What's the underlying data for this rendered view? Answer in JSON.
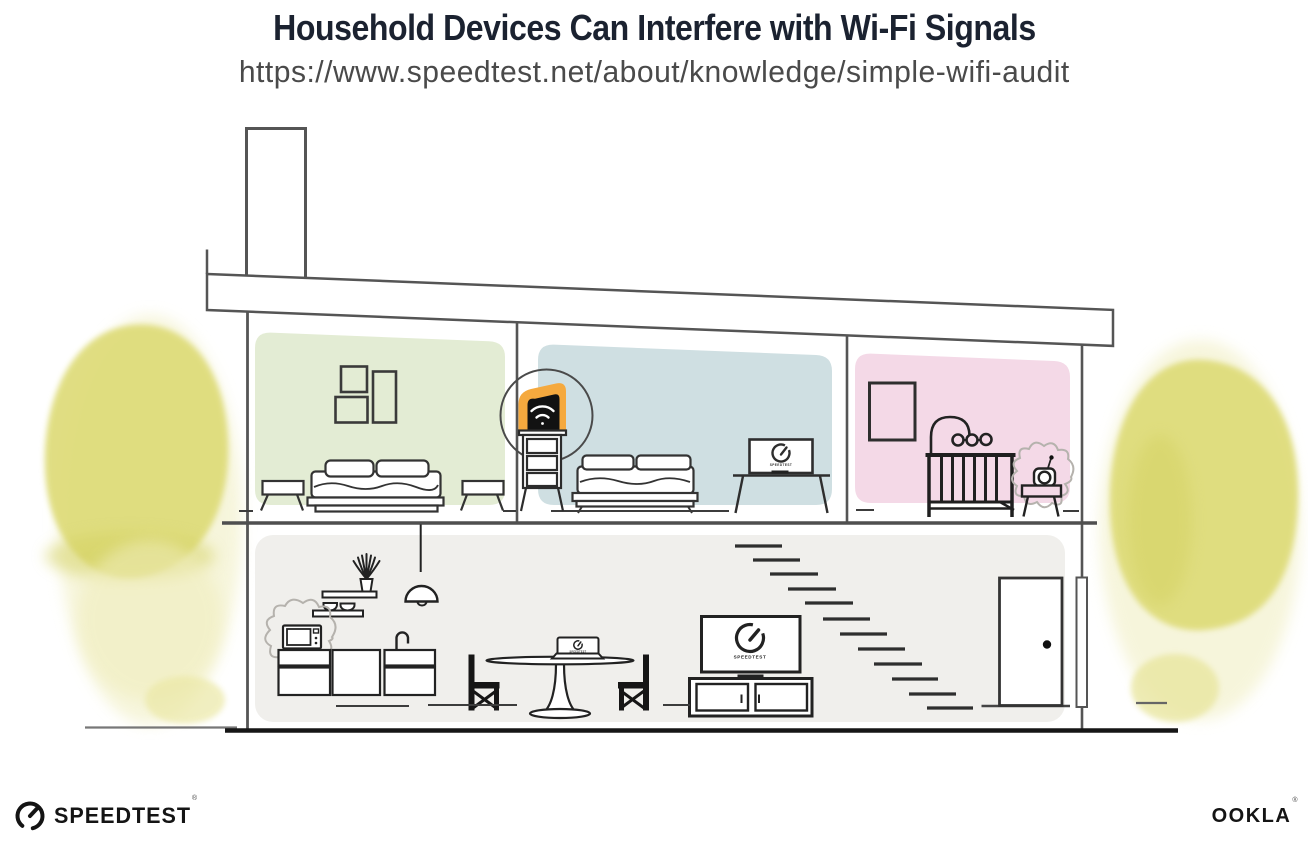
{
  "header": {
    "title": "Household Devices Can Interfere with Wi-Fi Signals",
    "url": "https://www.speedtest.net/about/knowledge/simple-wifi-audit"
  },
  "footer": {
    "speedtest_wordmark": "SPEEDTEST",
    "speedtest_reg_mark": "®",
    "ookla_wordmark": "OOKLA",
    "ookla_reg_mark": "®"
  },
  "illustration": {
    "device_screens_label": "SPEEDTEST",
    "rooms": [
      {
        "name": "bedroom-left",
        "wall_color": "#e3ecd4"
      },
      {
        "name": "bedroom-center",
        "wall_color": "#cfdfe2"
      },
      {
        "name": "nursery",
        "wall_color": "#f4d9e7"
      },
      {
        "name": "downstairs-living-kitchen",
        "wall_color": "#f0efec"
      }
    ],
    "highlighted_device": "wifi-router",
    "interference_devices": [
      "microwave-oven",
      "baby-monitor"
    ],
    "colors": {
      "router_highlight": "#f5a93e",
      "foliage": "#dedb78",
      "outline": "#555555"
    }
  }
}
